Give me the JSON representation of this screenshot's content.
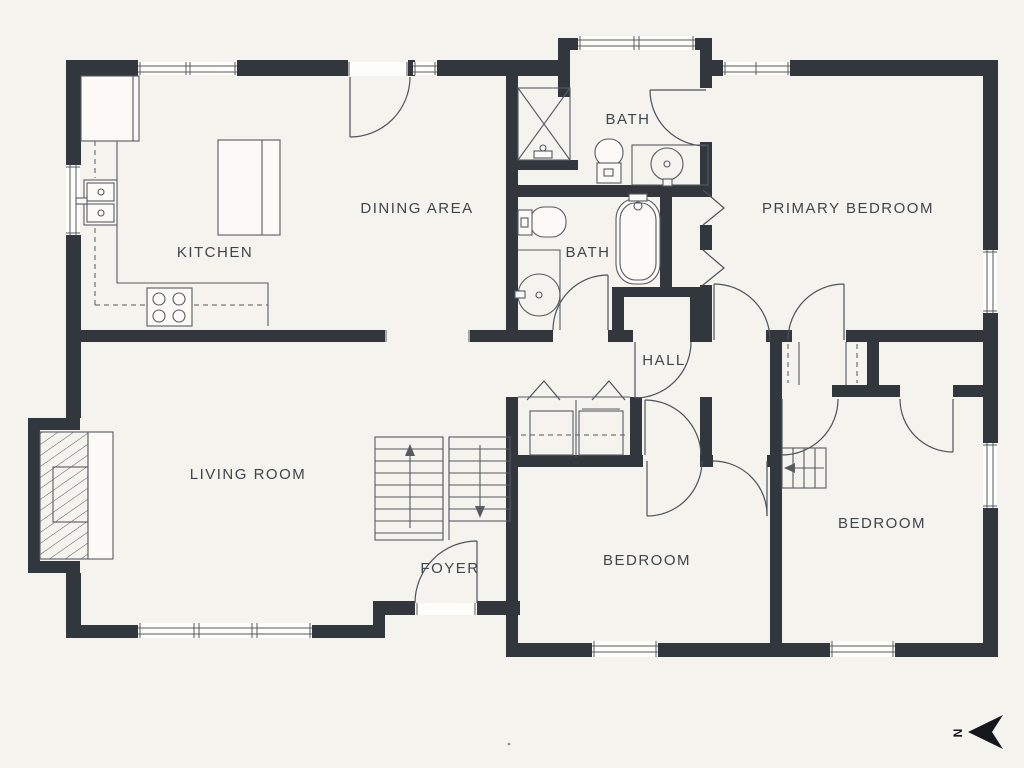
{
  "drawing": {
    "type": "residential-floor-plan",
    "colors": {
      "background": "#f4f3ee",
      "walls": "#31373d",
      "lines": "#565b60",
      "labels": "#3f464c",
      "fixture_fill": "#fbfaf6"
    }
  },
  "rooms": [
    {
      "id": "kitchen",
      "label": "KITCHEN"
    },
    {
      "id": "dining-area",
      "label": "DINING AREA"
    },
    {
      "id": "bath-top",
      "label": "BATH"
    },
    {
      "id": "bath-middle",
      "label": "BATH"
    },
    {
      "id": "primary-bedroom",
      "label": "PRIMARY BEDROOM"
    },
    {
      "id": "hall",
      "label": "HALL"
    },
    {
      "id": "living-room",
      "label": "LIVING ROOM"
    },
    {
      "id": "foyer",
      "label": "FOYER"
    },
    {
      "id": "bedroom-center",
      "label": "BEDROOM"
    },
    {
      "id": "bedroom-right",
      "label": "BEDROOM"
    }
  ],
  "compass": {
    "label": "N",
    "direction": "left"
  }
}
